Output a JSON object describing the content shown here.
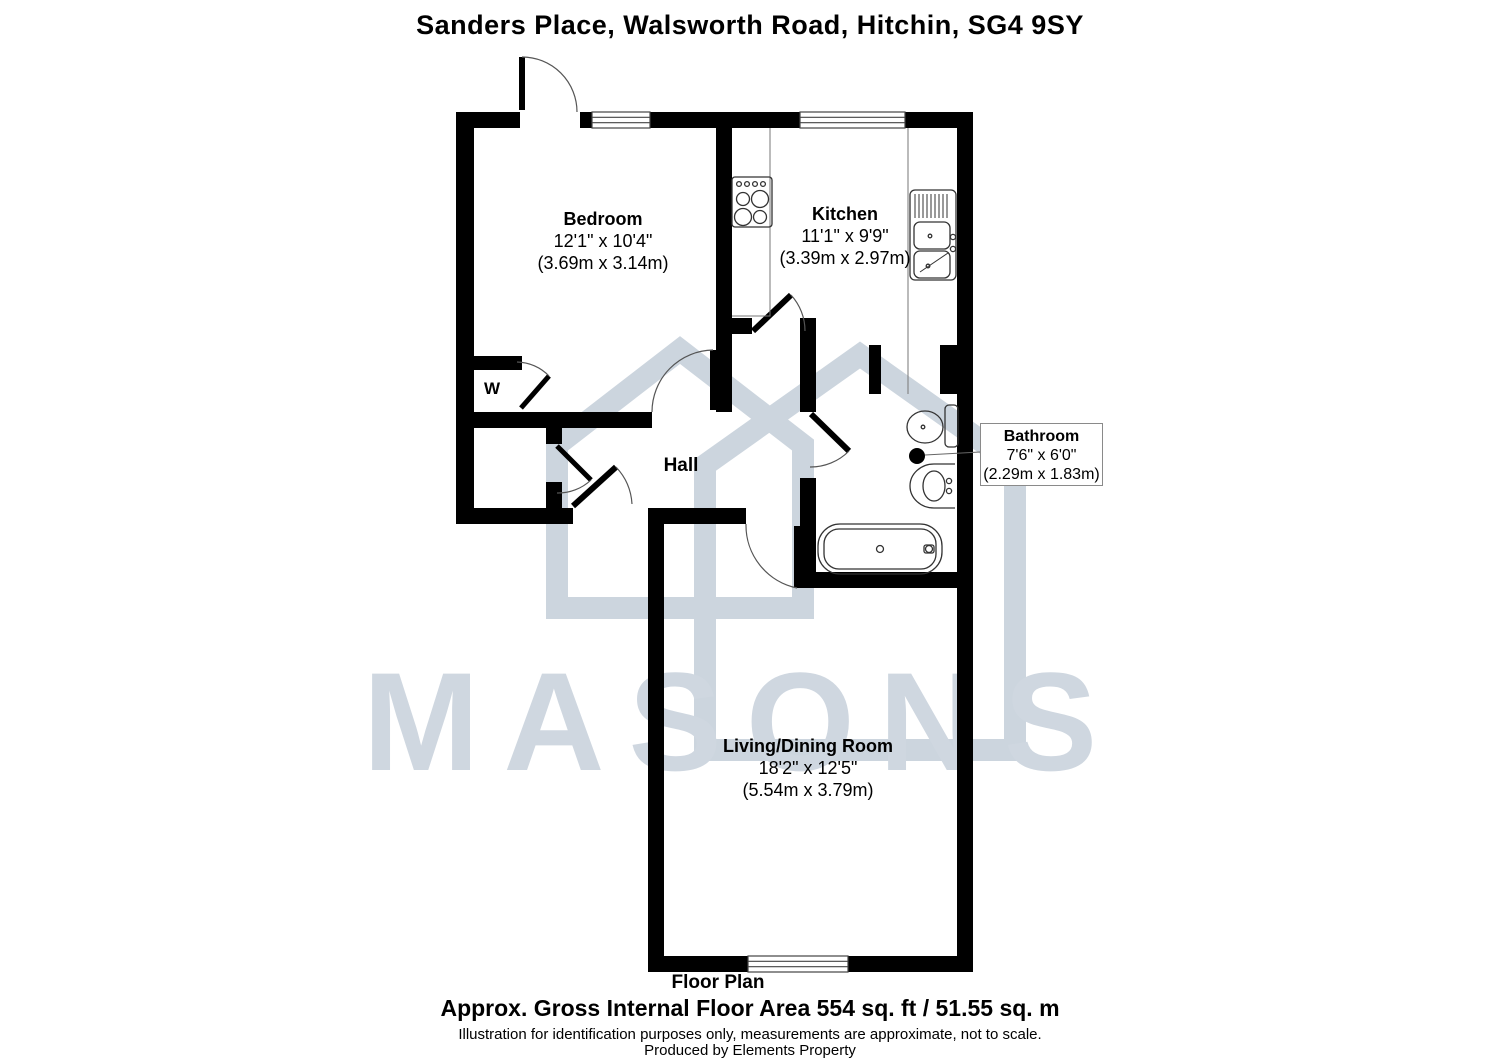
{
  "title": "Sanders Place, Walsworth Road, Hitchin, SG4 9SY",
  "watermark": {
    "text": "MASONS",
    "color": "#cfd7e0",
    "logo": "masons-house-logo"
  },
  "rooms": {
    "bedroom": {
      "name": "Bedroom",
      "dims_ft": "12'1\" x 10'4\"",
      "dims_m": "(3.69m x 3.14m)"
    },
    "kitchen": {
      "name": "Kitchen",
      "dims_ft": "11'1\" x 9'9\"",
      "dims_m": "(3.39m x 2.97m)"
    },
    "hall": {
      "name": "Hall"
    },
    "wardrobe": {
      "name": "W"
    },
    "bathroom": {
      "name": "Bathroom",
      "dims_ft": "7'6\" x 6'0\"",
      "dims_m": "(2.29m x 1.83m)"
    },
    "living": {
      "name": "Living/Dining Room",
      "dims_ft": "18'2\" x 12'5\"",
      "dims_m": "(5.54m x 3.79m)"
    }
  },
  "footer": {
    "plan_label": "Floor Plan",
    "area": "Approx. Gross Internal Floor Area 554 sq. ft / 51.55 sq. m",
    "disclaimer": "Illustration for identification purposes only, measurements are approximate, not to scale.",
    "producer": "Produced by Elements Property"
  }
}
